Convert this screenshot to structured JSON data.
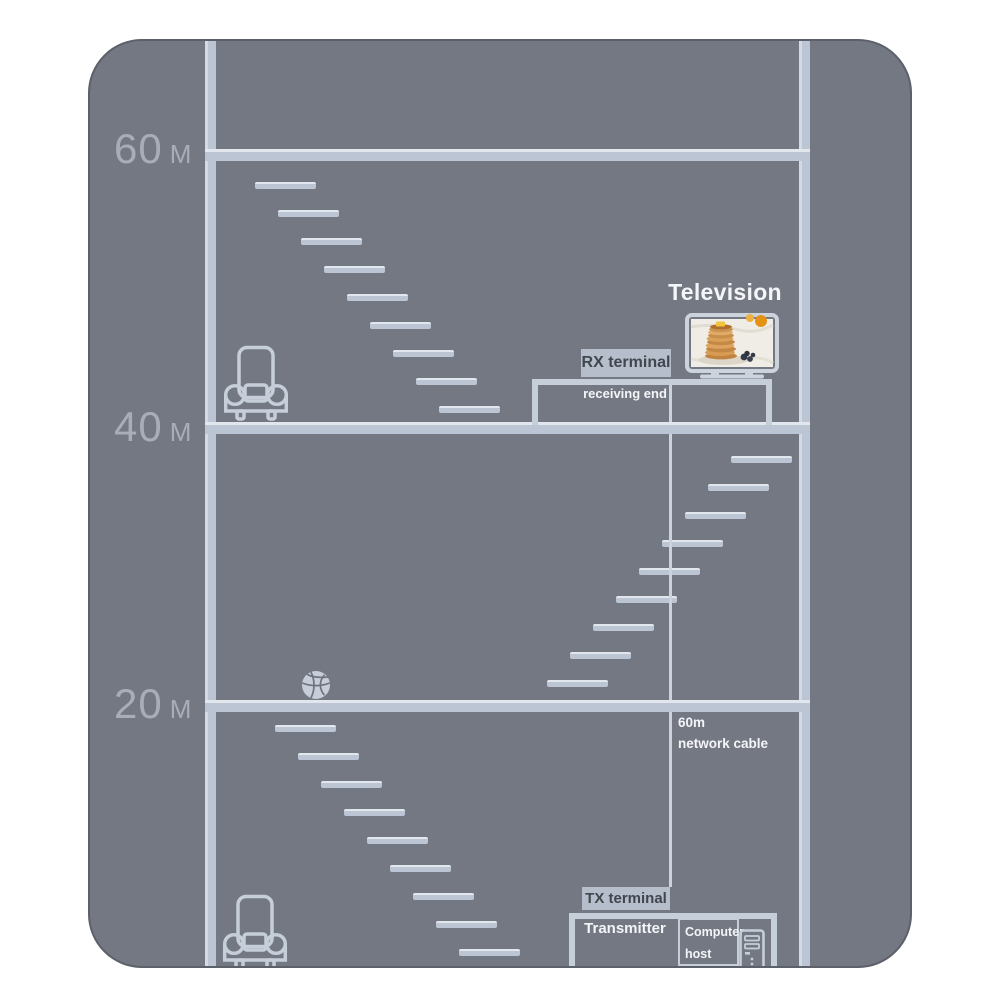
{
  "colors": {
    "page_bg": "#ffffff",
    "building": "#747882",
    "line": "#bcc5d3",
    "line_hi": "#e2e7ee",
    "label": "#a8aeb9",
    "badge_bg": "#b5beca",
    "badge_text": "#42474f",
    "text_white": "#f3f5f8",
    "cable": "#ccd3dd",
    "outline": "#c6ced9"
  },
  "floors": [
    {
      "value": "60",
      "unit": "M"
    },
    {
      "value": "40",
      "unit": "M"
    },
    {
      "value": "20",
      "unit": "M"
    }
  ],
  "television": {
    "label": "Television"
  },
  "rx": {
    "badge": "RX terminal",
    "caption": "receiving end"
  },
  "tx": {
    "badge": "TX terminal",
    "caption": "Transmitter"
  },
  "computer": {
    "line1": "Computer",
    "line2": "host"
  },
  "cable": {
    "line1": "60m",
    "line2": "network cable"
  }
}
